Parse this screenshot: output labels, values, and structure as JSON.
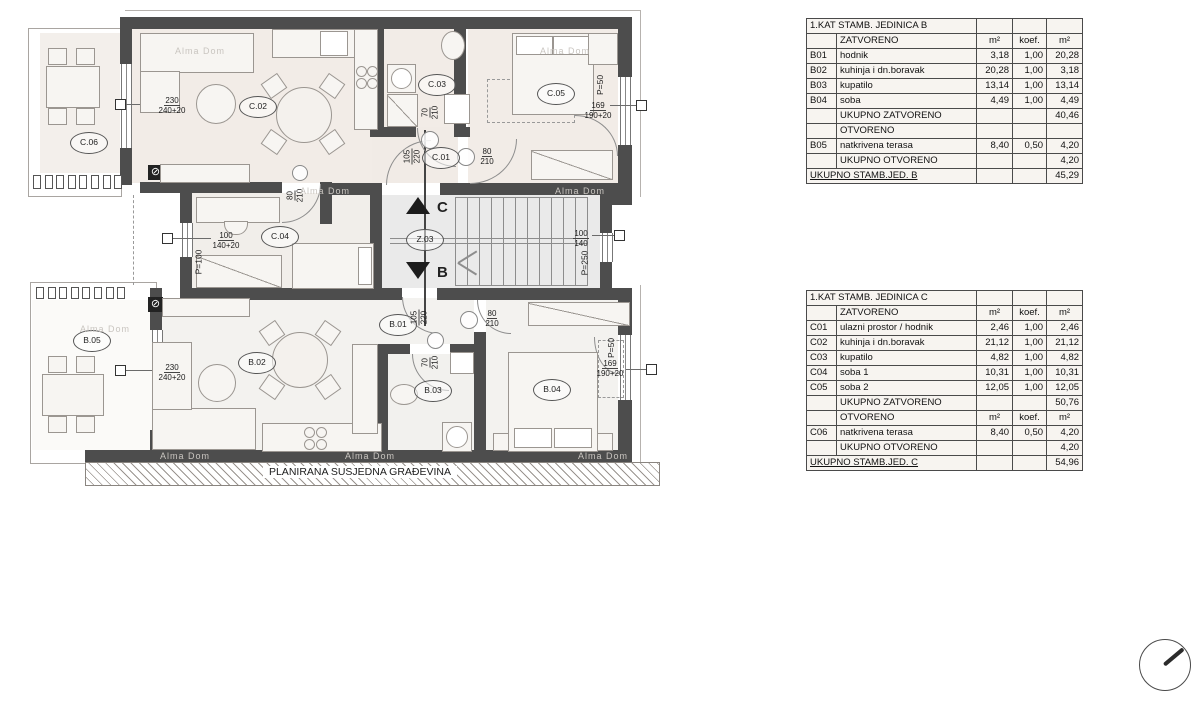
{
  "plan": {
    "watermark": "Alma Dom",
    "neighbor_label": "PLANIRANA SUSJEDNA GRAĐEVINA",
    "room_labels": [
      {
        "id": "C.06",
        "x": 88,
        "y": 142
      },
      {
        "id": "C.02",
        "x": 257,
        "y": 106
      },
      {
        "id": "C.03",
        "x": 436,
        "y": 84
      },
      {
        "id": "C.01",
        "x": 440,
        "y": 157
      },
      {
        "id": "C.05",
        "x": 555,
        "y": 93
      },
      {
        "id": "C.04",
        "x": 279,
        "y": 236
      },
      {
        "id": "Z.03",
        "x": 424,
        "y": 239
      },
      {
        "id": "B.01",
        "x": 397,
        "y": 324
      },
      {
        "id": "B.05",
        "x": 91,
        "y": 340
      },
      {
        "id": "B.02",
        "x": 256,
        "y": 362
      },
      {
        "id": "B.03",
        "x": 432,
        "y": 390
      },
      {
        "id": "B.04",
        "x": 551,
        "y": 389
      }
    ],
    "dim_labels": [
      {
        "top": "230",
        "bottom": "240+20",
        "x": 172,
        "y": 105,
        "rot": 0
      },
      {
        "top": "230",
        "bottom": "240+20",
        "x": 172,
        "y": 372,
        "rot": 0
      },
      {
        "top": "100",
        "bottom": "140+20",
        "x": 226,
        "y": 240,
        "rot": 0
      },
      {
        "top": "100",
        "bottom": "140",
        "x": 581,
        "y": 238,
        "rot": 0
      },
      {
        "top": "169",
        "bottom": "190+20",
        "x": 598,
        "y": 110,
        "rot": 0
      },
      {
        "top": "169",
        "bottom": "190+20",
        "x": 610,
        "y": 368,
        "rot": 0
      },
      {
        "top": "70",
        "bottom": "210",
        "x": 430,
        "y": 112,
        "rot": 1
      },
      {
        "top": "70",
        "bottom": "210",
        "x": 430,
        "y": 362,
        "rot": 1
      },
      {
        "top": "105",
        "bottom": "220",
        "x": 412,
        "y": 156,
        "rot": 1
      },
      {
        "top": "105",
        "bottom": "220",
        "x": 419,
        "y": 317,
        "rot": 1
      },
      {
        "top": "80",
        "bottom": "210",
        "x": 487,
        "y": 156,
        "rot": 0
      },
      {
        "top": "80",
        "bottom": "210",
        "x": 492,
        "y": 318,
        "rot": 0
      },
      {
        "top": "80",
        "bottom": "210",
        "x": 295,
        "y": 195,
        "rot": 1
      }
    ],
    "parapet_labels": [
      {
        "text": "P=50",
        "x": 602,
        "y": 85
      },
      {
        "text": "P=50",
        "x": 613,
        "y": 348
      },
      {
        "text": "P=100",
        "x": 198,
        "y": 262
      },
      {
        "text": "P=250",
        "x": 584,
        "y": 263
      }
    ],
    "section_marks": [
      {
        "letter": "C",
        "x": 437,
        "y": 199
      },
      {
        "letter": "B",
        "x": 437,
        "y": 264
      }
    ],
    "watermarks": [
      {
        "x": 175,
        "y": 46
      },
      {
        "x": 540,
        "y": 46
      },
      {
        "x": 300,
        "y": 186
      },
      {
        "x": 555,
        "y": 186
      },
      {
        "x": 80,
        "y": 324
      },
      {
        "x": 160,
        "y": 451
      },
      {
        "x": 345,
        "y": 451
      },
      {
        "x": 578,
        "y": 451
      }
    ]
  },
  "tables": {
    "b": {
      "title": "1.KAT STAMB. JEDINICA B",
      "rows": [
        {
          "t": "h",
          "c": [
            "",
            "ZATVORENO",
            "m²",
            "koef.",
            "m²"
          ]
        },
        {
          "t": "d",
          "c": [
            "B01",
            "hodnik",
            "3,18",
            "1,00",
            "20,28"
          ]
        },
        {
          "t": "d",
          "c": [
            "B02",
            "kuhinja i dn.boravak",
            "20,28",
            "1,00",
            "3,18"
          ]
        },
        {
          "t": "d",
          "c": [
            "B03",
            "kupatilo",
            "13,14",
            "1,00",
            "13,14"
          ]
        },
        {
          "t": "d",
          "c": [
            "B04",
            "soba",
            "4,49",
            "1,00",
            "4,49"
          ]
        },
        {
          "t": "s",
          "c": [
            "",
            "UKUPNO ZATVORENO",
            "",
            "",
            "40,46"
          ]
        },
        {
          "t": "s",
          "c": [
            "",
            "OTVORENO",
            "",
            "",
            ""
          ]
        },
        {
          "t": "d",
          "c": [
            "B05",
            "natkrivena terasa",
            "8,40",
            "0,50",
            "4,20"
          ]
        },
        {
          "t": "s",
          "c": [
            "",
            "UKUPNO OTVORENO",
            "",
            "",
            "4,20"
          ]
        }
      ],
      "total_label": "UKUPNO STAMB.JED. B",
      "total_value": "45,29"
    },
    "c": {
      "title": "1.KAT STAMB. JEDINICA C",
      "rows": [
        {
          "t": "h",
          "c": [
            "",
            "ZATVORENO",
            "m²",
            "koef.",
            "m²"
          ]
        },
        {
          "t": "d",
          "c": [
            "C01",
            "ulazni prostor / hodnik",
            "2,46",
            "1,00",
            "2,46"
          ]
        },
        {
          "t": "d",
          "c": [
            "C02",
            "kuhinja i dn.boravak",
            "21,12",
            "1,00",
            "21,12"
          ]
        },
        {
          "t": "d",
          "c": [
            "C03",
            "kupatilo",
            "4,82",
            "1,00",
            "4,82"
          ]
        },
        {
          "t": "d",
          "c": [
            "C04",
            "soba 1",
            "10,31",
            "1,00",
            "10,31"
          ]
        },
        {
          "t": "d",
          "c": [
            "C05",
            "soba 2",
            "12,05",
            "1,00",
            "12,05"
          ]
        },
        {
          "t": "s",
          "c": [
            "",
            "UKUPNO ZATVORENO",
            "",
            "",
            "50,76"
          ]
        },
        {
          "t": "h",
          "c": [
            "",
            "OTVORENO",
            "m²",
            "koef.",
            "m²"
          ]
        },
        {
          "t": "d",
          "c": [
            "C06",
            "natkrivena terasa",
            "8,40",
            "0,50",
            "4,20"
          ]
        },
        {
          "t": "s",
          "c": [
            "",
            "UKUPNO OTVORENO",
            "",
            "",
            "4,20"
          ]
        }
      ],
      "total_label": "UKUPNO STAMB.JED. C",
      "total_value": "54,96"
    }
  }
}
